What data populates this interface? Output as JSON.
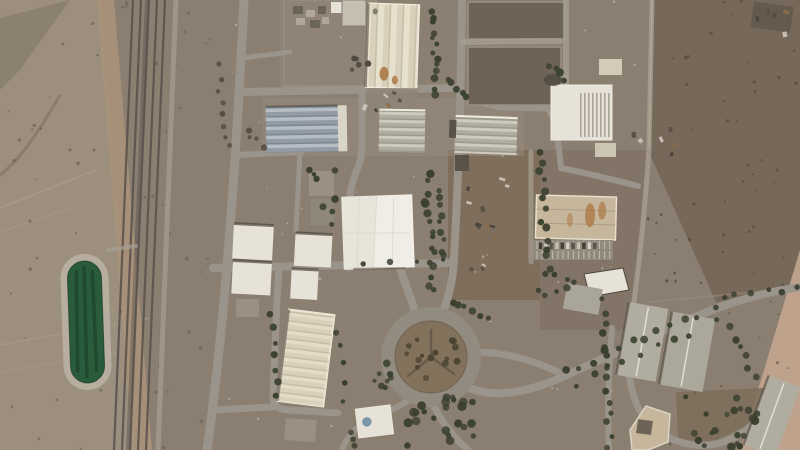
{
  "meta": {
    "alt_text": "Overhead satellite photograph of a desert industrial facility: railway tracks on the left, a green water reservoir, warehouse buildings with striped roofs, a tree-lined road grid, a landscaped traffic roundabout, and open desert terrain."
  },
  "palette": {
    "desert_base": "#8B7F71",
    "desert_left": "#9C8F7E",
    "desert_dark": "#77695A",
    "desert_pink": "#C3A68E",
    "dirt_brown": "#7D6D5A",
    "dirt_tan": "#A8927A",
    "apron": "#958B7C",
    "yard": "#8F8577",
    "water_green": "#2A5C3C",
    "water_dark": "#1C4129",
    "rim": "#B7AEA0",
    "roundabout_dirt": "#82715B",
    "white_bldg": "#E6E2D7",
    "bright_white": "#EFEDE6",
    "cream_bldg": "#D8D0BA",
    "bluegray_roof": "#929CA6",
    "gray_roof": "#B1ACA0",
    "gray_roof2": "#9A9183",
    "tan_bldg": "#C6B69C",
    "annex_tan": "#D3CBB8",
    "dark_yard": "#6D6357",
    "dark_bldg": "#5A5349",
    "rust": "#A9743F",
    "dome_blue": "#7B96A5",
    "tree": "#3A402E",
    "tree_brown": "#4A4433",
    "shrub": "#554C3E",
    "shadow": "#4E473E",
    "parking_lot": "#908A7D"
  },
  "scene": {
    "tree_rows": [
      {
        "x1": 434,
        "y1": 10,
        "x2": 437,
        "y2": 95,
        "n": 13,
        "j": 3,
        "r": 3.2
      },
      {
        "x1": 427,
        "y1": 175,
        "x2": 433,
        "y2": 292,
        "n": 16,
        "j": 4,
        "r": 3.4
      },
      {
        "x1": 440,
        "y1": 188,
        "x2": 445,
        "y2": 258,
        "n": 9,
        "j": 3,
        "r": 3
      },
      {
        "x1": 447,
        "y1": 80,
        "x2": 468,
        "y2": 95,
        "n": 5,
        "j": 3,
        "r": 3
      },
      {
        "x1": 540,
        "y1": 152,
        "x2": 546,
        "y2": 258,
        "n": 12,
        "j": 3,
        "r": 3.2
      },
      {
        "x1": 549,
        "y1": 64,
        "x2": 563,
        "y2": 78,
        "n": 4,
        "j": 3,
        "r": 3.4
      },
      {
        "x1": 217,
        "y1": 65,
        "x2": 229,
        "y2": 148,
        "n": 8,
        "j": 3,
        "r": 2.4,
        "c": "shrub"
      },
      {
        "x1": 451,
        "y1": 301,
        "x2": 488,
        "y2": 318,
        "n": 6,
        "j": 3,
        "r": 3.2
      },
      {
        "x1": 563,
        "y1": 370,
        "x2": 700,
        "y2": 317,
        "n": 11,
        "j": 4,
        "r": 3.4
      },
      {
        "x1": 578,
        "y1": 385,
        "x2": 688,
        "y2": 334,
        "n": 8,
        "j": 4,
        "r": 3
      },
      {
        "x1": 604,
        "y1": 300,
        "x2": 610,
        "y2": 445,
        "n": 14,
        "j": 3,
        "r": 3.2
      },
      {
        "x1": 714,
        "y1": 309,
        "x2": 757,
        "y2": 378,
        "n": 8,
        "j": 4,
        "r": 3.2
      },
      {
        "x1": 722,
        "y1": 297,
        "x2": 795,
        "y2": 289,
        "n": 6,
        "j": 3,
        "r": 2.8
      },
      {
        "x1": 271,
        "y1": 312,
        "x2": 277,
        "y2": 398,
        "n": 7,
        "j": 3,
        "r": 3
      },
      {
        "x1": 339,
        "y1": 330,
        "x2": 345,
        "y2": 400,
        "n": 5,
        "j": 3,
        "r": 2.8
      },
      {
        "x1": 363,
        "y1": 262,
        "x2": 444,
        "y2": 260,
        "n": 4,
        "j": 2,
        "r": 2.6
      },
      {
        "x1": 247,
        "y1": 128,
        "x2": 262,
        "y2": 148,
        "n": 4,
        "j": 3,
        "r": 2.6,
        "c": "shrub"
      }
    ],
    "tree_scatters": [
      {
        "x": 403,
        "y": 331,
        "w": 57,
        "h": 53,
        "n": 15,
        "r": 2.8,
        "c": "brown"
      },
      {
        "x": 407,
        "y": 397,
        "w": 73,
        "h": 50,
        "n": 24,
        "r": 3.6
      },
      {
        "x": 681,
        "y": 396,
        "w": 78,
        "h": 51,
        "n": 20,
        "r": 3.4
      },
      {
        "x": 533,
        "y": 259,
        "w": 42,
        "h": 40,
        "n": 9,
        "r": 3.2
      },
      {
        "x": 374,
        "y": 356,
        "w": 28,
        "h": 46,
        "n": 8,
        "r": 3
      },
      {
        "x": 344,
        "y": 428,
        "w": 18,
        "h": 18,
        "n": 3,
        "r": 2.8
      },
      {
        "x": 306,
        "y": 168,
        "w": 36,
        "h": 58,
        "n": 8,
        "r": 3
      },
      {
        "x": 352,
        "y": 56,
        "w": 16,
        "h": 38,
        "n": 5,
        "r": 3,
        "c": "shadow"
      }
    ],
    "speckle_regions": [
      {
        "x": 648,
        "y": 0,
        "w": 150,
        "h": 290,
        "n": 48,
        "rmin": 0.8,
        "rmax": 1.8,
        "c": "#564C40",
        "o": 0.8
      },
      {
        "x": 0,
        "y": 0,
        "w": 135,
        "h": 450,
        "n": 40,
        "rmin": 0.8,
        "rmax": 1.8,
        "c": "#6E6254",
        "o": 0.7
      },
      {
        "x": 210,
        "y": 0,
        "w": 430,
        "h": 440,
        "n": 55,
        "rmin": 0.6,
        "rmax": 1.4,
        "c": "#CFC6B6",
        "o": 0.55
      },
      {
        "x": 650,
        "y": 300,
        "w": 140,
        "h": 145,
        "n": 18,
        "rmin": 0.8,
        "rmax": 1.6,
        "c": "#5A5043",
        "o": 0.6
      },
      {
        "x": 140,
        "y": 0,
        "w": 70,
        "h": 450,
        "n": 26,
        "rmin": 0.8,
        "rmax": 2.0,
        "c": "#5E5549",
        "o": 0.5
      }
    ],
    "debris_clusters": [
      {
        "x": 462,
        "y": 175,
        "w": 45,
        "h": 115,
        "n": 14
      },
      {
        "x": 366,
        "y": 90,
        "w": 50,
        "h": 18,
        "n": 6
      },
      {
        "x": 620,
        "y": 120,
        "w": 60,
        "h": 40,
        "n": 6
      },
      {
        "x": 755,
        "y": 2,
        "w": 40,
        "h": 30,
        "n": 5
      }
    ],
    "parking": {
      "x": 537,
      "y": 241,
      "cols": 15,
      "step": 5.2,
      "stall_h": 8,
      "row_gap": 10
    },
    "vehicles": {
      "x": 539,
      "y": 242.5,
      "n": 11,
      "step": 5.4
    }
  }
}
